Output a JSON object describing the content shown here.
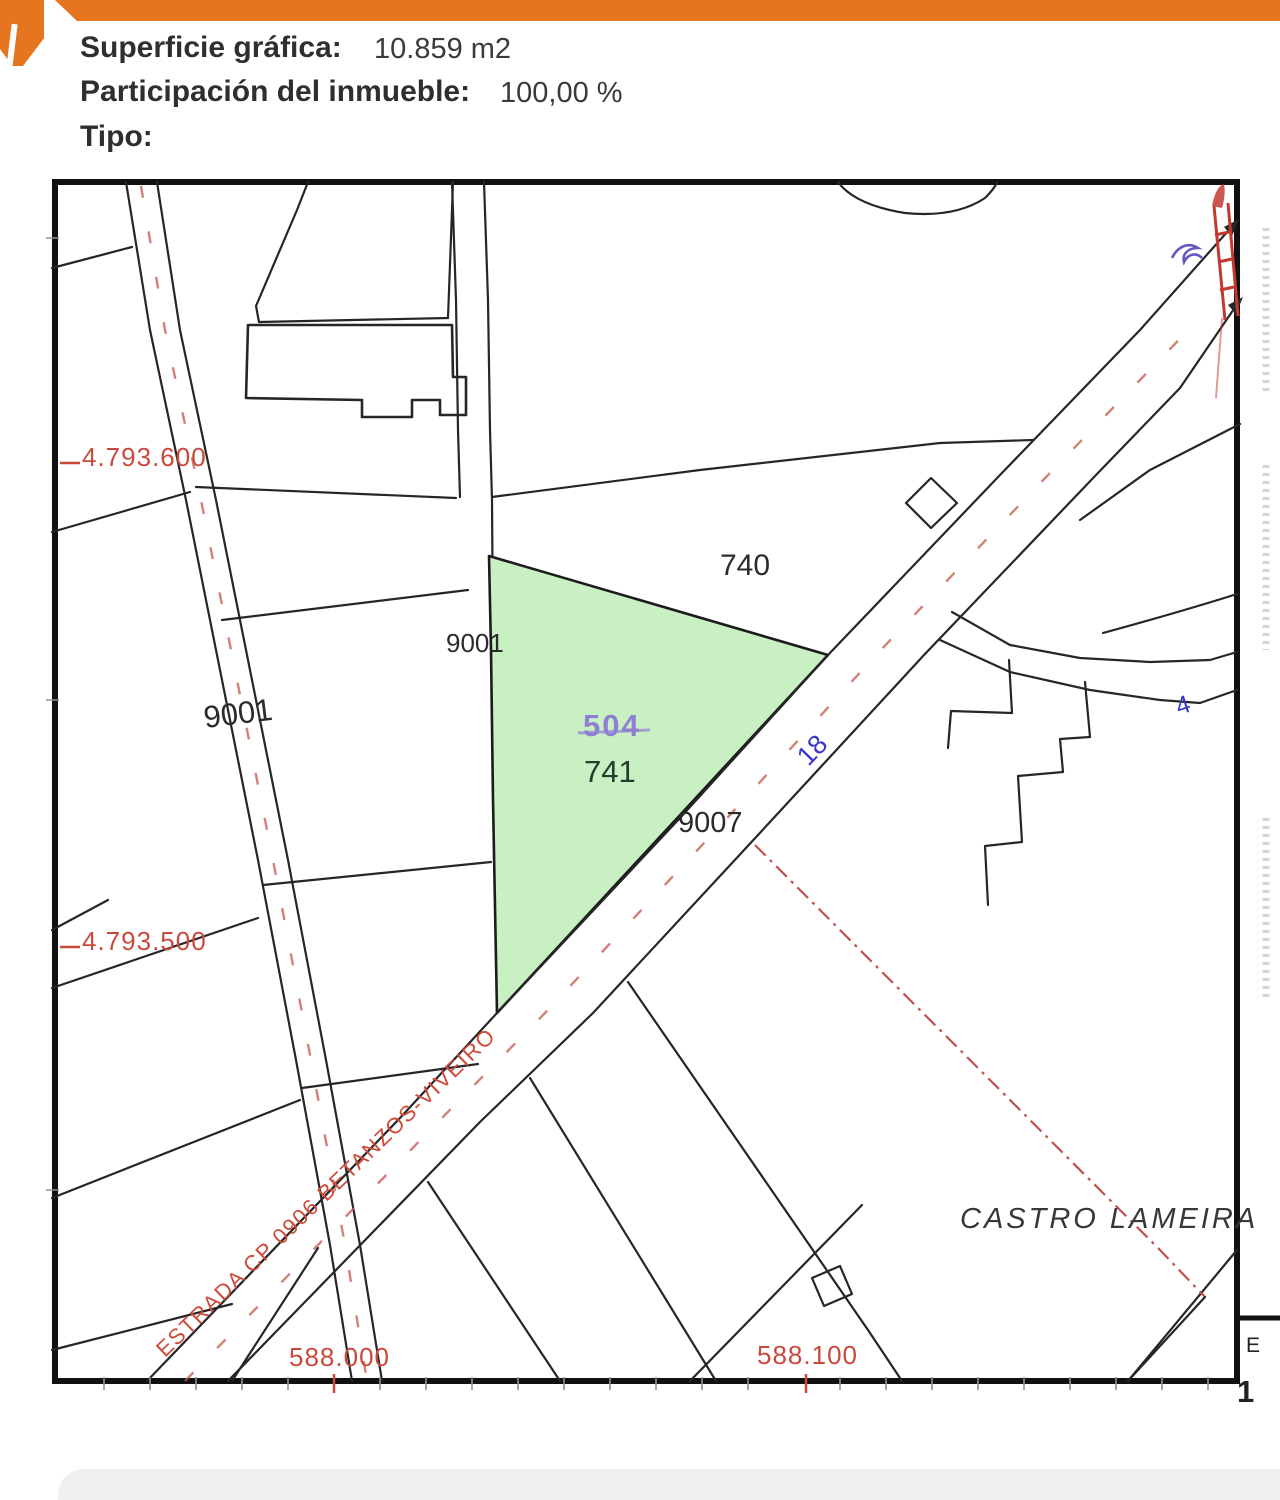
{
  "header": {
    "superficie_label": "Superficie gráfica:",
    "superficie_value": "10.859 m2",
    "participacion_label": "Participación del inmueble:",
    "participacion_value": "100,00 %",
    "tipo_label": "Tipo:"
  },
  "map": {
    "parcel_740": "740",
    "road_left_code": "9001",
    "road_mid_code": "9001",
    "road_main_code": "9007",
    "subparcel_code": "504",
    "parcel_741": "741",
    "road_number": "18",
    "branch_number": "4",
    "coord_north_1": "4.793.600",
    "coord_north_2": "4.793.500",
    "coord_east_1": "588.000",
    "coord_east_2": "588.100",
    "road_name": "ESTRADA CP 0906 BETANZOS-VIVEIRO",
    "place_name": "CASTRO LAMEIRA",
    "scale_letter": "E",
    "scale_number": "1"
  },
  "colors": {
    "accent_orange": "#e5751f",
    "parcel_highlight_green": "#c9f0c3",
    "subparcel_purple": "#8e7fd2",
    "road_number_blue": "#3b35c8",
    "cadastral_red": "#c94a3d"
  }
}
